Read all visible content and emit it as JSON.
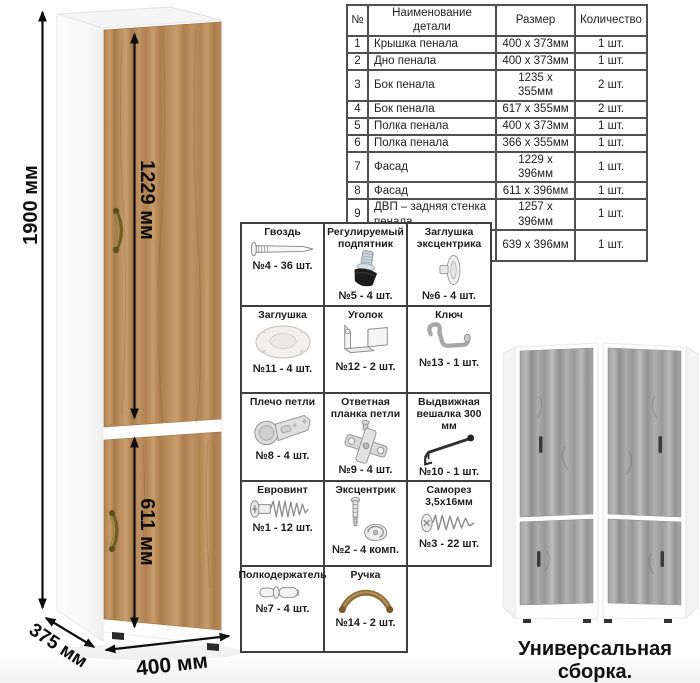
{
  "main_diagram": {
    "dim_height": "1900 мм",
    "dim_upper_door": "1229 мм",
    "dim_lower_door": "611 мм",
    "dim_width": "400 мм",
    "dim_depth": "375 мм"
  },
  "parts_table": {
    "headers": [
      "№",
      "Наименование детали",
      "Размер",
      "Количество"
    ],
    "rows": [
      [
        "1",
        "Крышка пенала",
        "400 x 373мм",
        "1 шт."
      ],
      [
        "2",
        "Дно пенала",
        "400 x 373мм",
        "1 шт."
      ],
      [
        "3",
        "Бок пенала",
        "1235 x 355мм",
        "2 шт."
      ],
      [
        "4",
        "Бок пенала",
        "617 x 355мм",
        "2 шт."
      ],
      [
        "5",
        "Полка пенала",
        "400 x 373мм",
        "1 шт."
      ],
      [
        "6",
        "Полка пенала",
        "366 x 355мм",
        "1 шт."
      ],
      [
        "7",
        "Фасад",
        "1229 x 396мм",
        "1 шт."
      ],
      [
        "8",
        "Фасад",
        "611 x 396мм",
        "1 шт."
      ],
      [
        "9",
        "ДВП – задняя стенка пенала",
        "1257 x 396мм",
        "1 шт."
      ],
      [
        "10",
        "ДВП – задняя стенка пенала",
        "639 x 396мм",
        "1 шт."
      ]
    ]
  },
  "hardware_grid": {
    "items": [
      {
        "name": "Гвоздь",
        "qty": "№4 - 36 шт.",
        "icon": "nail-icon"
      },
      {
        "name": "Регулируемый подпятник",
        "qty": "№5 - 4 шт.",
        "icon": "adjustable-foot-icon"
      },
      {
        "name": "Заглушка эксцентрика",
        "qty": "№6 - 4 шт.",
        "icon": "cam-cover-icon"
      },
      {
        "name": "Заглушка",
        "qty": "№11 - 4 шт.",
        "icon": "cap-icon"
      },
      {
        "name": "Уголок",
        "qty": "№12 - 2 шт.",
        "icon": "corner-bracket-icon"
      },
      {
        "name": "Ключ",
        "qty": "№13 - 1 шт.",
        "icon": "hex-key-icon"
      },
      {
        "name": "Плечо петли",
        "qty": "№8 - 4 шт.",
        "icon": "hinge-arm-icon"
      },
      {
        "name": "Ответная планка петли",
        "qty": "№9 - 4 шт.",
        "icon": "hinge-plate-icon"
      },
      {
        "name": "Выдвижная вешалка 300 мм",
        "qty": "№10 - 1 шт.",
        "icon": "pullout-hanger-icon"
      },
      {
        "name": "Евровинт",
        "qty": "№1 - 12 шт.",
        "icon": "euroscrew-icon"
      },
      {
        "name": "Эксцентрик",
        "qty": "№2 - 4 комп.",
        "icon": "cam-lock-icon"
      },
      {
        "name": "Саморез 3,5x16мм",
        "qty": "№3 - 22 шт.",
        "icon": "self-tapping-screw-icon"
      },
      {
        "name": "Полкодержатель",
        "qty": "№7 - 4 шт.",
        "icon": "shelf-pin-icon"
      },
      {
        "name": "Ручка",
        "qty": "№14 - 2 шт.",
        "icon": "handle-icon"
      }
    ]
  },
  "footer": {
    "caption": "Универсальная сборка."
  },
  "colors": {
    "oak_wood": "#b98c5c",
    "gray_wood": "#9e9e9e",
    "handle_bronze": "#7d682c",
    "dimension_arrow": "#0d0d0d",
    "table_border": "#4f4f4f"
  }
}
